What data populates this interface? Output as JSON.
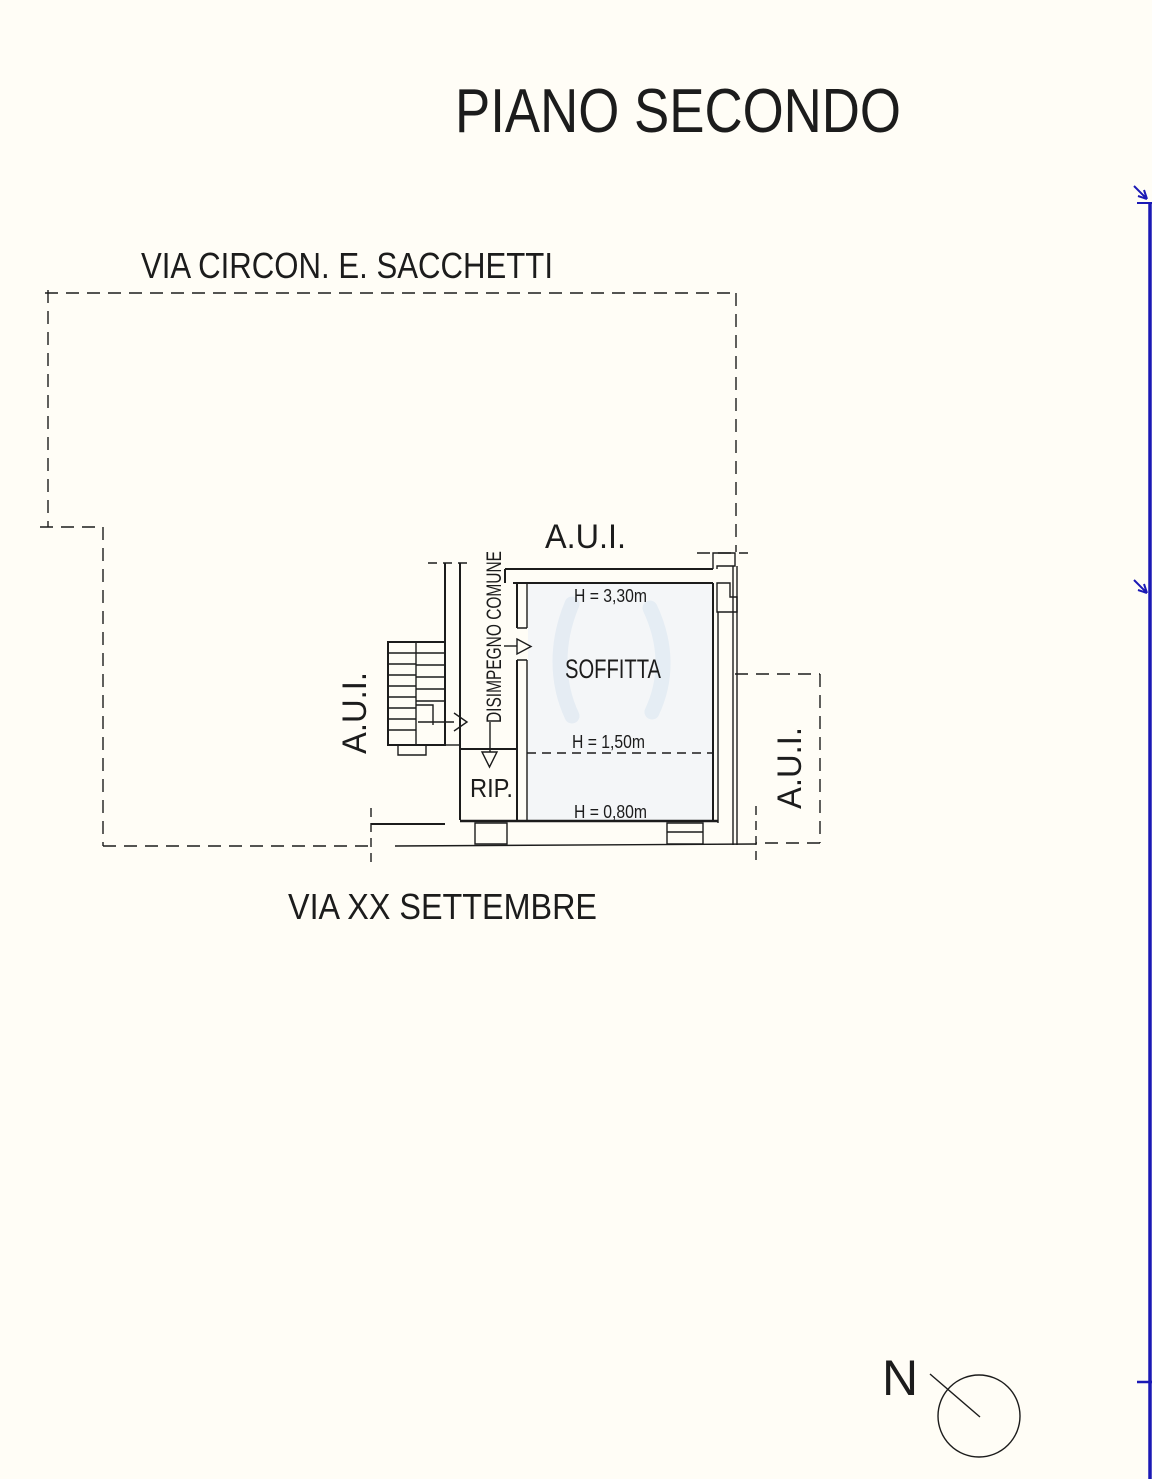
{
  "page": {
    "title": "PIANO SECONDO"
  },
  "streets": {
    "top": "VIA CIRCON. E. SACCHETTI",
    "bottom": "VIA XX SETTEMBRE"
  },
  "units": {
    "top": "A.U.I.",
    "left": "A.U.I.",
    "right": "A.U.I."
  },
  "rooms": {
    "corridor": "DISIMPEGNO COMUNE",
    "attic": "SOFFITTA",
    "storage": "RIP."
  },
  "heights": {
    "top": "H = 3,30m",
    "mid": "H = 1,50m",
    "low": "H = 0,80m"
  },
  "compass": {
    "north": "N"
  },
  "colors": {
    "line": "#1c1c1c",
    "height_text": "#858585",
    "room_text": "#5f5f5f",
    "corridor_text": "#2a2a2a",
    "blue_edge": "#1b19b5",
    "paper": "#fffdf6",
    "room_fill": "#f4f6f8",
    "watermark": "#d9e5f0"
  }
}
